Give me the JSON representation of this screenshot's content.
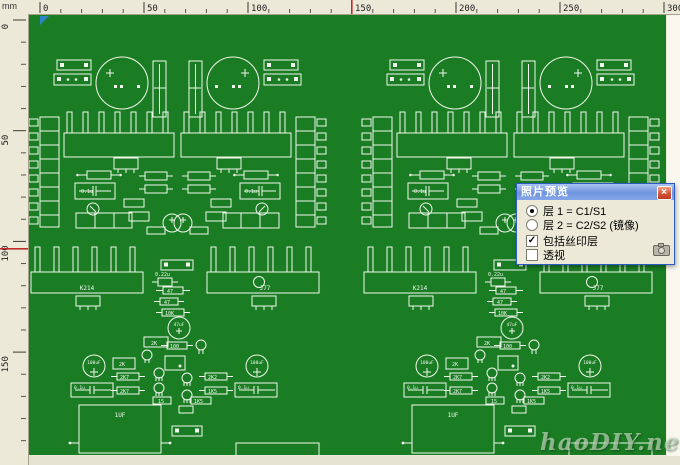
{
  "rulers": {
    "unit": "mm",
    "h_labels": [
      "0",
      "50",
      "100",
      "150",
      "200",
      "250",
      "300"
    ],
    "v_labels": [
      "0",
      "50",
      "100",
      "150"
    ],
    "cursor_color": "#c02a2a"
  },
  "board": {
    "color": "#1a7d23",
    "silk_color": "#f2f7ef"
  },
  "pcb": {
    "labels": {
      "k214": "K214",
      "j77": "J77",
      "c_1uf": "1UF",
      "c_01u": "0.1u",
      "c_022u": "0.22u",
      "c_47uf": "47uF",
      "c_100uf": "100uF",
      "r47": "47",
      "r10k": "10K",
      "r100": "100",
      "r2k": "2K",
      "r2k7": "2K7",
      "r2k2": "2K2",
      "r15": "15",
      "r1k5": "1K5"
    }
  },
  "dialog": {
    "title": "照片预览",
    "close_glyph": "×",
    "options": [
      {
        "type": "radio",
        "checked": true,
        "label": "层 1 = C1/S1"
      },
      {
        "type": "radio",
        "checked": false,
        "label": "层 2 = C2/S2 (镜像)"
      },
      {
        "type": "checkbox",
        "checked": true,
        "label": "包括丝印层"
      },
      {
        "type": "checkbox",
        "checked": false,
        "label": "透视"
      }
    ]
  },
  "watermark": "haoDIY.net"
}
